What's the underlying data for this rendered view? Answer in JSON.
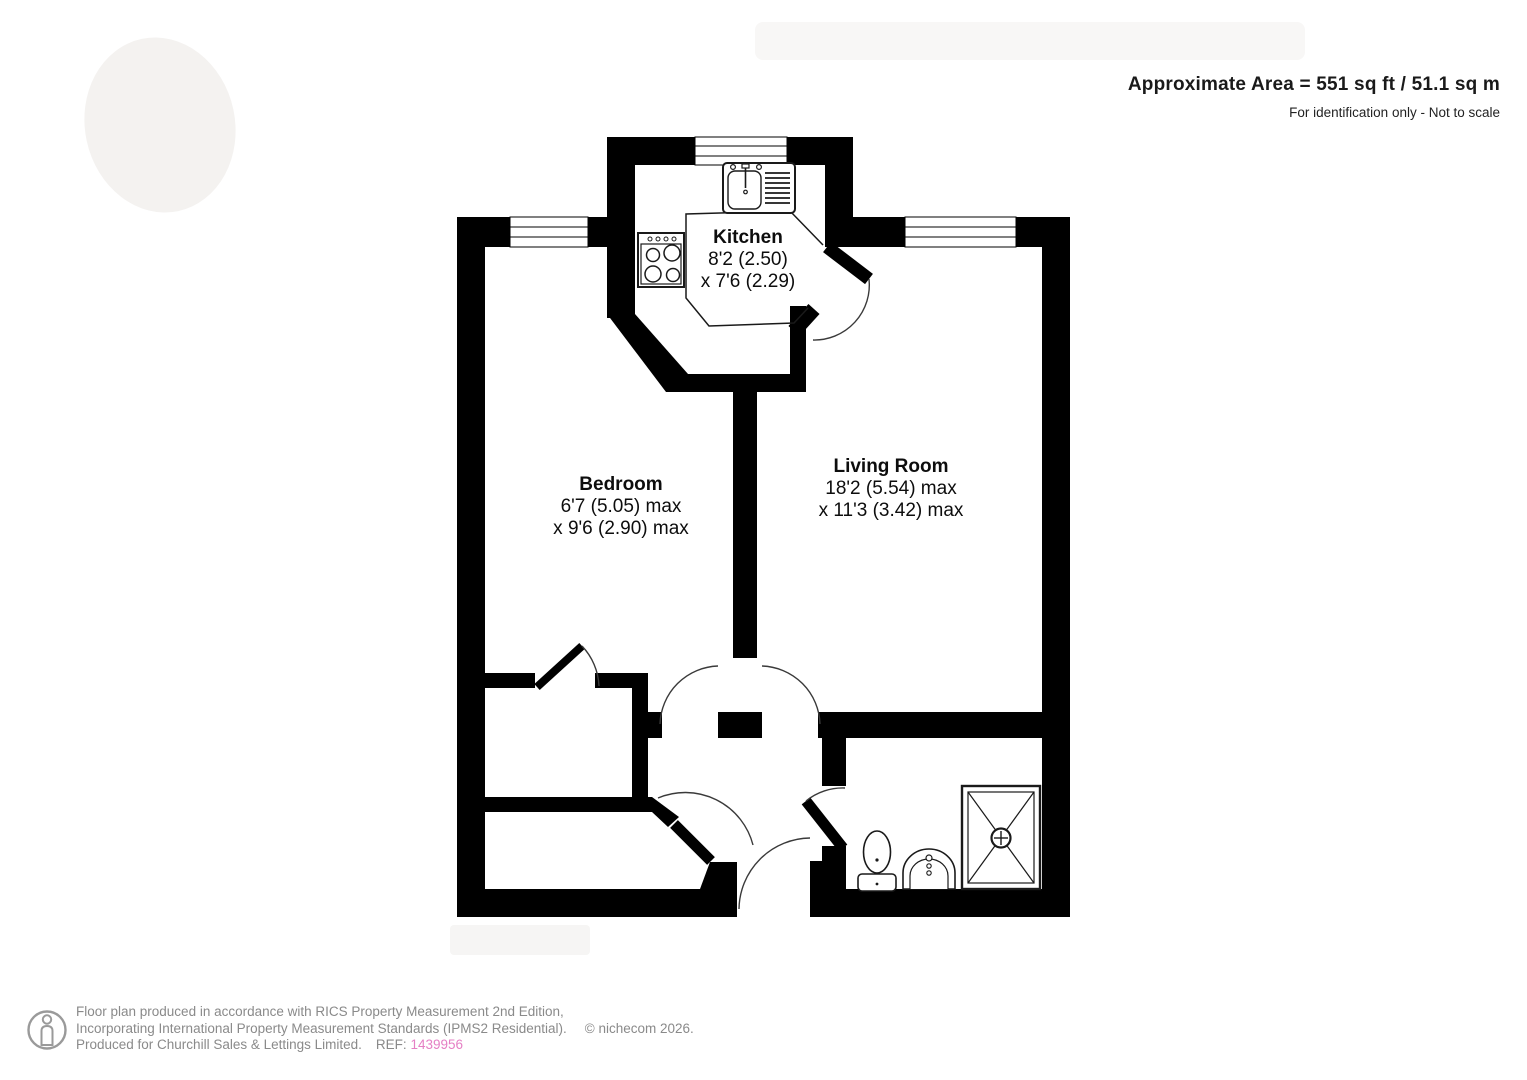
{
  "header": {
    "area_text": "Approximate Area = 551 sq ft / 51.1 sq m",
    "scale_note": "For identification only - Not to scale"
  },
  "rooms": [
    {
      "id": "kitchen",
      "name": "Kitchen",
      "dim_line1": "8'2 (2.50)",
      "dim_line2": "x 7'6 (2.29)"
    },
    {
      "id": "bedroom",
      "name": "Bedroom",
      "dim_line1": "6'7 (5.05) max",
      "dim_line2": "x 9'6 (2.90) max"
    },
    {
      "id": "living_room",
      "name": "Living Room",
      "dim_line1": "18'2 (5.54) max",
      "dim_line2": "x 11'3 (3.42) max"
    }
  ],
  "fixture_icons": [
    "sink-drainer-icon",
    "hob-icon",
    "toilet-icon",
    "basin-icon",
    "shower-icon"
  ],
  "footer": {
    "line1": "Floor plan produced in accordance with RICS Property Measurement 2nd Edition,",
    "line2": "Incorporating International Property Measurement Standards (IPMS2 Residential).",
    "line3": "Produced for Churchill Sales & Lettings Limited.",
    "ref_label": "REF:",
    "ref_number": "1439956",
    "copyright": "© nichecom 2026."
  },
  "colors": {
    "wall": "#000000",
    "footer_text": "#8a8a8a",
    "ref_number_pink": "#e57fc4"
  }
}
